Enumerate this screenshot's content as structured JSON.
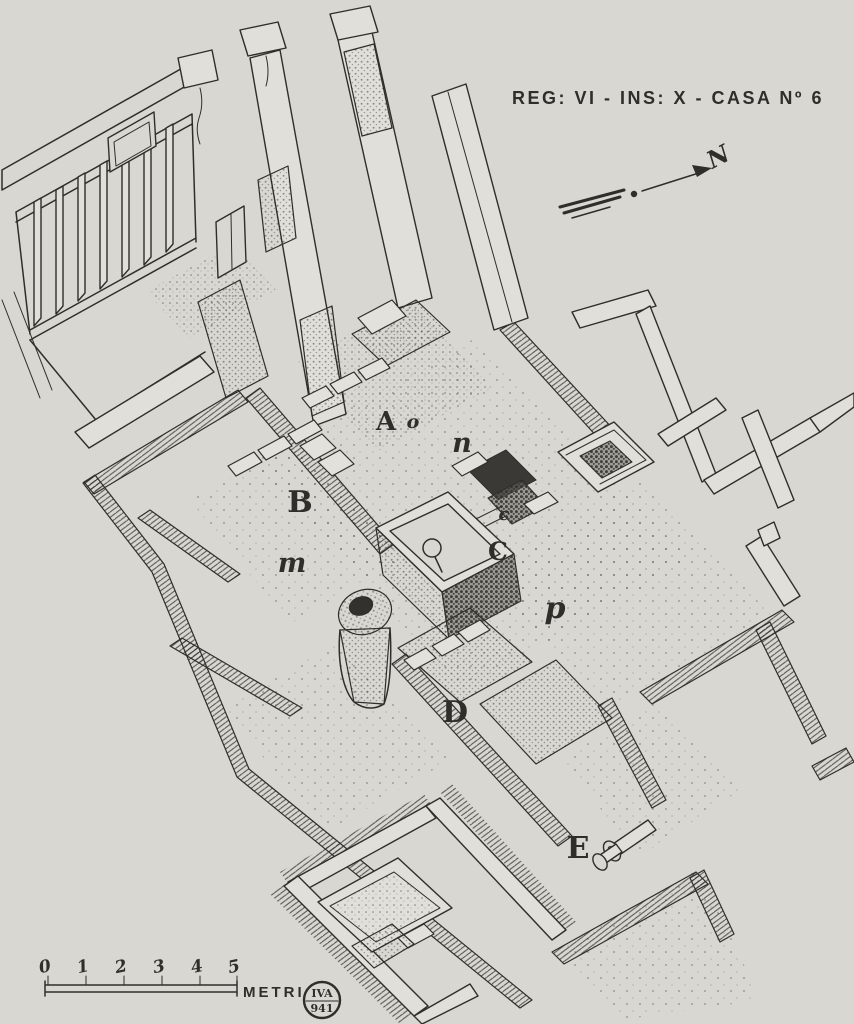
{
  "palette": {
    "paper": "#d8d7d2",
    "ink": "#2f2e2a"
  },
  "title": {
    "text": "REG: VI - INS: X - CASA Nº 6"
  },
  "north": {
    "label": "N"
  },
  "scalebar": {
    "ticks": [
      "0",
      "1",
      "2",
      "3",
      "4",
      "5"
    ],
    "unit": "METRI"
  },
  "stamp": {
    "line1": "IVA",
    "line2": "941"
  },
  "labels": [
    {
      "text": "A"
    },
    {
      "text": "o"
    },
    {
      "text": "n"
    },
    {
      "text": "B"
    },
    {
      "text": "m"
    },
    {
      "text": "c"
    },
    {
      "text": "C"
    },
    {
      "text": "p"
    },
    {
      "text": "D"
    },
    {
      "text": "E"
    }
  ]
}
